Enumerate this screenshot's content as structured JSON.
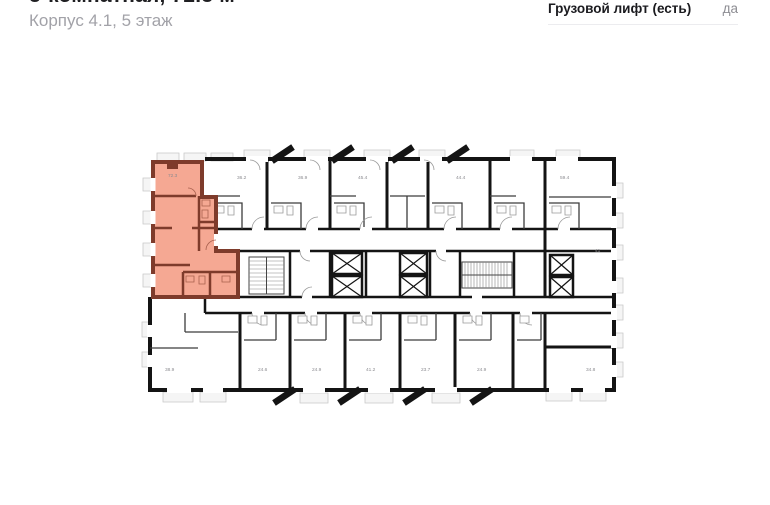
{
  "header": {
    "title_line1": "3-комнатная, 72.3 м²",
    "title_line2": "Корпус 4.1, 5 этаж",
    "property_row": {
      "label": "Грузовой лифт (есть)",
      "value": "да"
    }
  },
  "floor_plan": {
    "highlighted_unit": {
      "area_label": "72.3",
      "fill": "#F5A893",
      "wall_color": "#7E3B2B"
    },
    "colors": {
      "walls": "#141414",
      "label_text": "#8b8b90",
      "balcony_fill": "#f5f5f5"
    },
    "unit_labels": [
      {
        "text": "72.3",
        "x": 168,
        "y": 177
      },
      {
        "text": "36.2",
        "x": 237,
        "y": 179
      },
      {
        "text": "36.9",
        "x": 298,
        "y": 179
      },
      {
        "text": "45.4",
        "x": 358,
        "y": 179
      },
      {
        "text": "44.4",
        "x": 456,
        "y": 179
      },
      {
        "text": "59.4",
        "x": 560,
        "y": 179
      },
      {
        "text": "41",
        "x": 595,
        "y": 252
      },
      {
        "text": "38.9",
        "x": 165,
        "y": 371
      },
      {
        "text": "24.6",
        "x": 258,
        "y": 371
      },
      {
        "text": "24.9",
        "x": 312,
        "y": 371
      },
      {
        "text": "41.2",
        "x": 366,
        "y": 371
      },
      {
        "text": "23.7",
        "x": 421,
        "y": 371
      },
      {
        "text": "24.9",
        "x": 477,
        "y": 371
      },
      {
        "text": "34.8",
        "x": 586,
        "y": 371
      }
    ]
  }
}
